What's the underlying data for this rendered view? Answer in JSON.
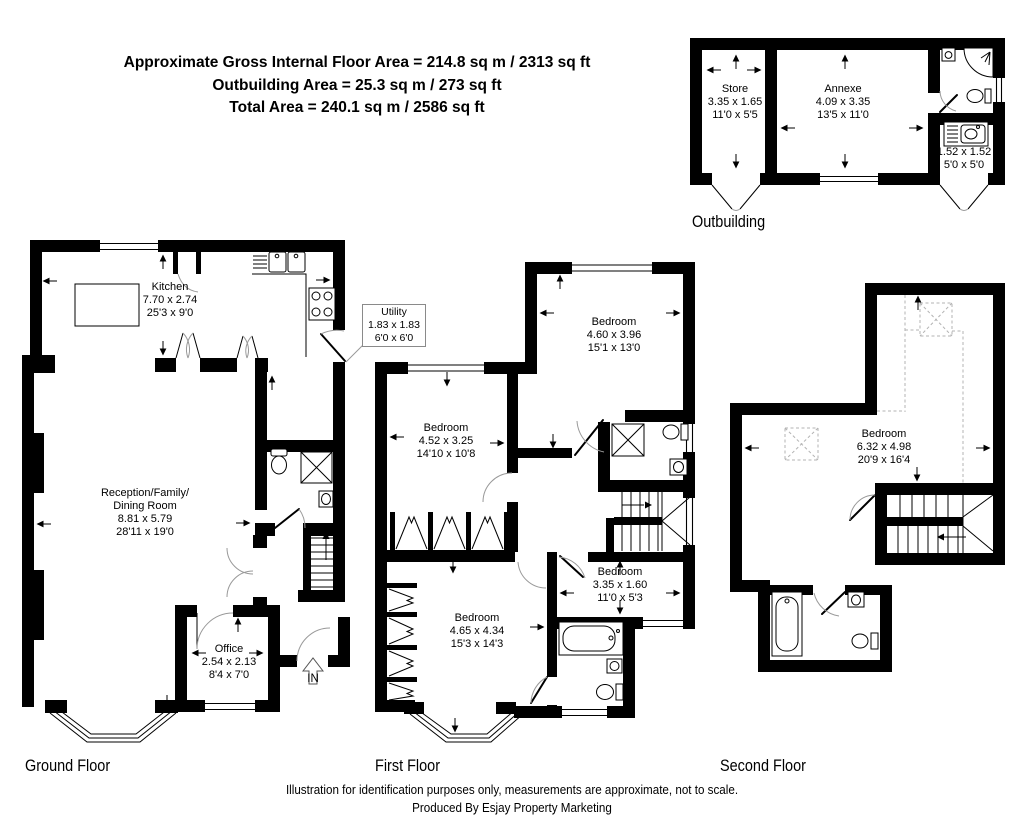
{
  "header": {
    "line1": "Approximate Gross Internal Floor Area = 214.8 sq m / 2313 sq ft",
    "line2": "Outbuilding Area = 25.3 sq m / 273 sq ft",
    "line3": "Total Area = 240.1 sq m / 2586 sq ft"
  },
  "outbuilding": {
    "label": "Outbuilding",
    "store": {
      "name": "Store",
      "metric": "3.35 x 1.65",
      "imperial": "11'0 x 5'5"
    },
    "annexe": {
      "name": "Annexe",
      "metric": "4.09 x 3.35",
      "imperial": "13'5 x 11'0"
    },
    "shower_room": {
      "metric": "1.52 x 1.52",
      "imperial": "5'0 x 5'0"
    }
  },
  "ground_floor": {
    "label": "Ground Floor",
    "kitchen": {
      "name": "Kitchen",
      "metric": "7.70 x 2.74",
      "imperial": "25'3 x 9'0"
    },
    "utility": {
      "name": "Utility",
      "metric": "1.83 x 1.83",
      "imperial": "6'0 x 6'0"
    },
    "reception": {
      "name_line1": "Reception/Family/",
      "name_line2": "Dining Room",
      "metric": "8.81 x 5.79",
      "imperial": "28'11 x 19'0"
    },
    "office": {
      "name": "Office",
      "metric": "2.54 x 2.13",
      "imperial": "8'4 x 7'0"
    },
    "entrance": "IN"
  },
  "first_floor": {
    "label": "First Floor",
    "bedroom_1": {
      "name": "Bedroom",
      "metric": "4.60 x 3.96",
      "imperial": "15'1 x 13'0"
    },
    "bedroom_2": {
      "name": "Bedroom",
      "metric": "4.52 x 3.25",
      "imperial": "14'10 x 10'8"
    },
    "bedroom_3": {
      "name": "Bedroom",
      "metric": "3.35 x 1.60",
      "imperial": "11'0 x 5'3"
    },
    "bedroom_4": {
      "name": "Bedroom",
      "metric": "4.65 x 4.34",
      "imperial": "15'3 x 14'3"
    }
  },
  "second_floor": {
    "label": "Second Floor",
    "bedroom": {
      "name": "Bedroom",
      "metric": "6.32 x 4.98",
      "imperial": "20'9 x 16'4"
    }
  },
  "footer": {
    "line1": "Illustration for identification purposes only, measurements are approximate, not to scale.",
    "line2": "Produced By Esjay Property Marketing"
  },
  "colors": {
    "wall": "#000000",
    "background": "#ffffff",
    "door_arc": "#999999",
    "dashed": "#b3b3b3"
  }
}
